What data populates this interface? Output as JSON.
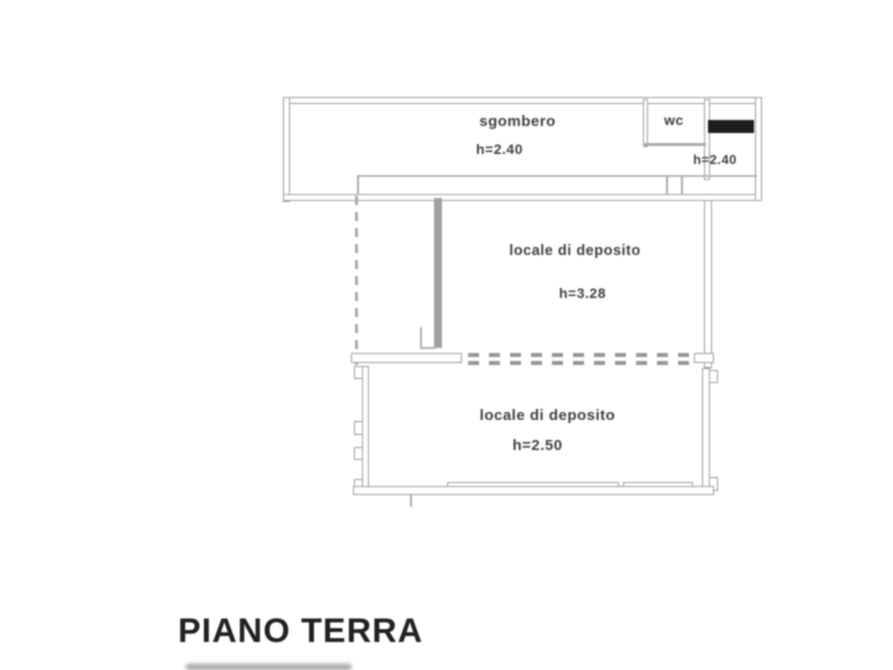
{
  "plan": {
    "floor_label": "PIANO TERRA",
    "rooms": [
      {
        "name": "sgombero",
        "label": "sgombero",
        "height": "h=2.40"
      },
      {
        "name": "wc",
        "label": "wc",
        "height": "h=2.40"
      },
      {
        "name": "locale-di-deposito-1",
        "label": "locale di deposito",
        "height": "h=3.28"
      },
      {
        "name": "locale-di-deposito-2",
        "label": "locale di deposito",
        "height": "h=2.50"
      }
    ],
    "colors": {
      "background": "#ffffff",
      "wall_line": "#9b9b9b",
      "label_text": "#3f3f3f",
      "dark_feature": "#1d1d1d",
      "title_text": "#212121"
    }
  }
}
